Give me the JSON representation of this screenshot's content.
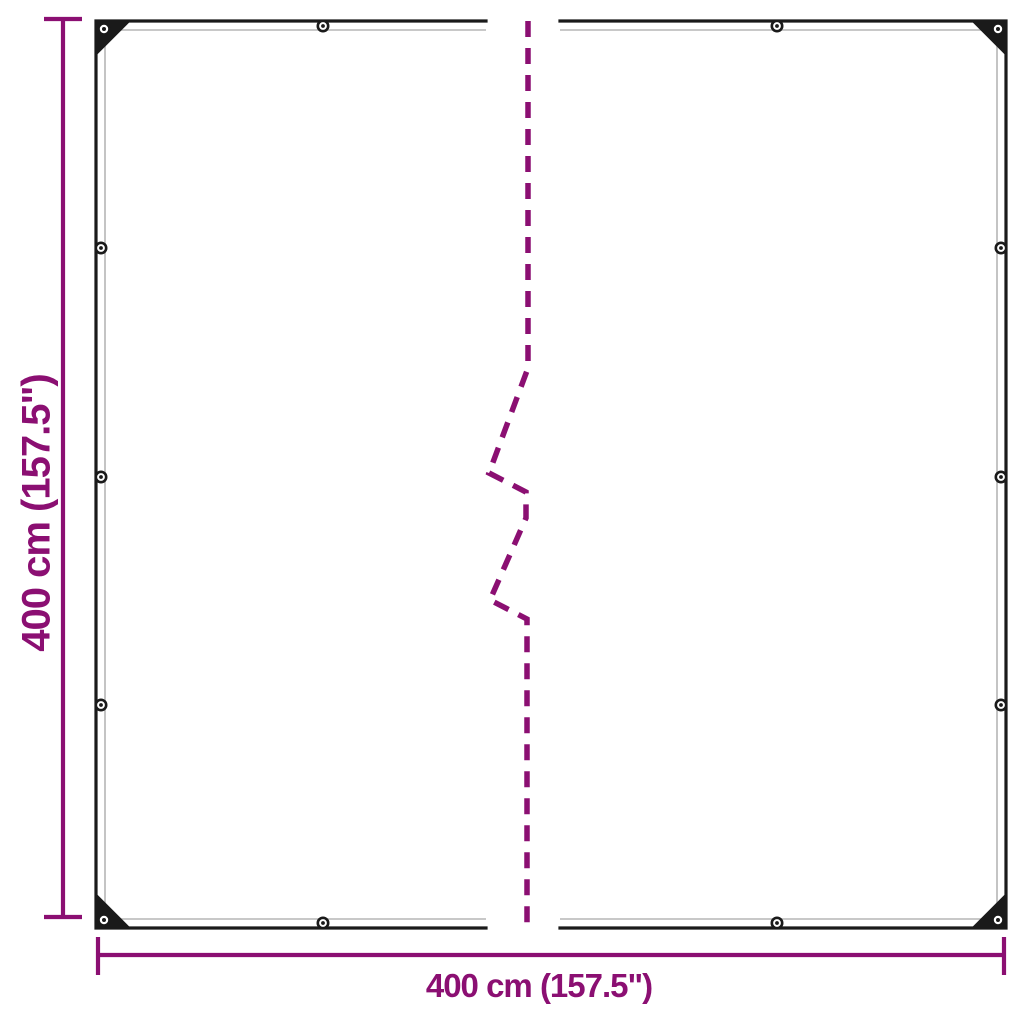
{
  "diagram": {
    "type": "product-dimension-diagram",
    "height_dimension": {
      "label": "400 cm (157.5\")"
    },
    "width_dimension": {
      "label": "400 cm (157.5\")"
    },
    "colors": {
      "dimension_accent": "#8B0F72",
      "outline": "#1A1A1A",
      "hem_stitch": "#B5B5B5",
      "background": "#FFFFFF"
    },
    "eyelets": {
      "corner_count": 4,
      "top_edge_count": 2,
      "bottom_edge_count": 2,
      "left_edge_count": 3,
      "right_edge_count": 3
    }
  }
}
